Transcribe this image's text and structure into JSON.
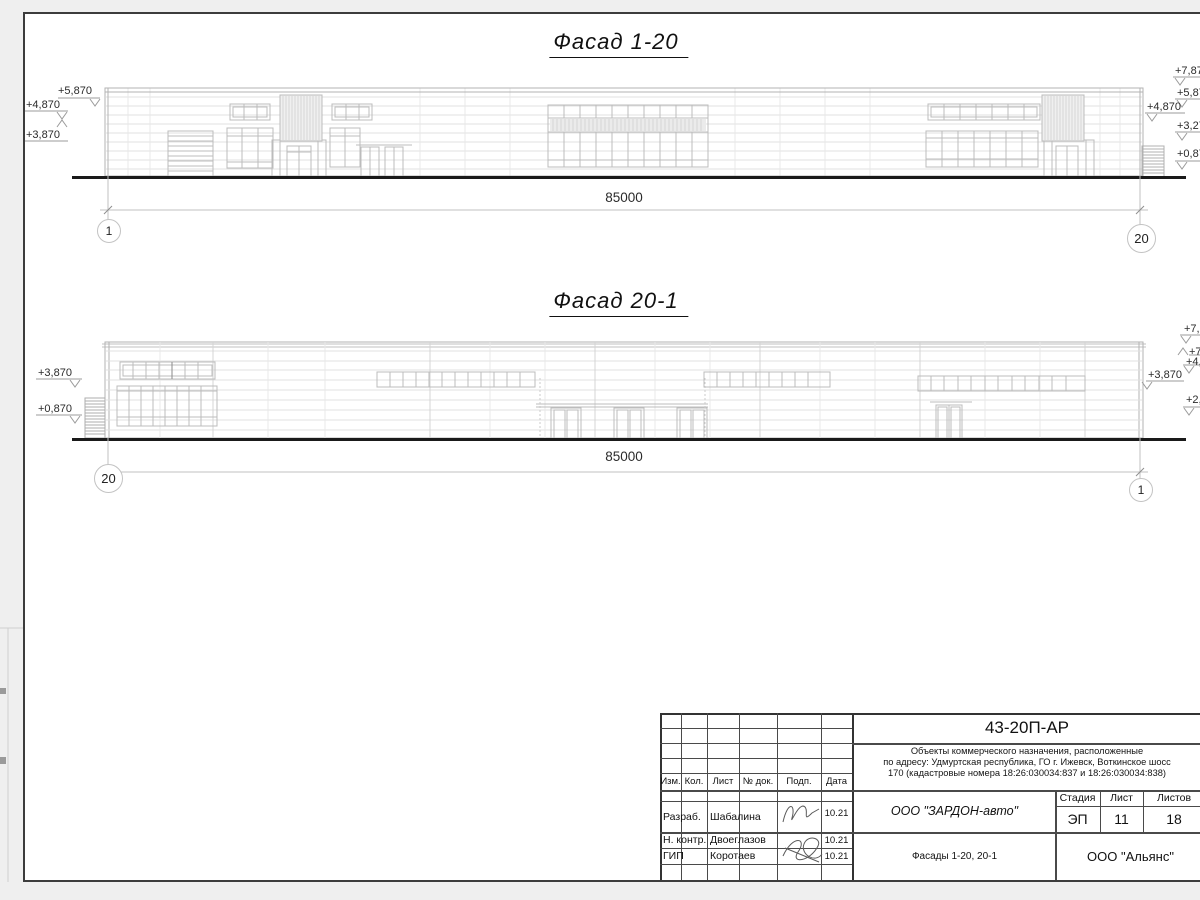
{
  "facade1": {
    "title": "Фасад 1-20",
    "dimension": "85000",
    "axis_left": "1",
    "axis_right": "20",
    "marks_left": [
      "+5,870",
      "+4,870",
      "+3,870"
    ],
    "marks_right": [
      "+7,87",
      "+5,87",
      "+4,870",
      "+3,27",
      "+0,87"
    ]
  },
  "facade2": {
    "title": "Фасад 20-1",
    "dimension": "85000",
    "axis_left": "20",
    "axis_right": "1",
    "marks_left": [
      "+3,870",
      "+0,870"
    ],
    "marks_right": [
      "+7,8",
      "+7,",
      "+4,8",
      "+3,870",
      "+2,1"
    ]
  },
  "titleblock": {
    "doc_number": "43-20П-АР",
    "desc1": "Объекты коммерческого назначения, расположенные",
    "desc2": "по адресу: Удмуртская республика, ГО г. Ижевск, Воткинское шосс",
    "desc3": "170 (кадастровые номера 18:26:030034:837 и 18:26:030034:838)",
    "header": {
      "izm": "Изм.",
      "kol": "Кол.",
      "list": "Лист",
      "doc": "№ док.",
      "podp": "Подп.",
      "data": "Дата"
    },
    "rows": [
      {
        "role": "Разраб.",
        "name": "Шабалина",
        "date": "10.21"
      },
      {
        "role": "Н. контр.",
        "name": "Двоеглазов",
        "date": "10.21"
      },
      {
        "role": "ГИП",
        "name": "Коротаев",
        "date": "10.21"
      }
    ],
    "company": "ООО \"ЗАРДОН-авто\"",
    "stage_label": "Стадия",
    "sheet_label": "Лист",
    "sheets_label": "Листов",
    "stage": "ЭП",
    "sheet_no": "11",
    "sheets_total": "18",
    "sheet_title": "Фасады 1-20, 20-1",
    "contractor": "ООО \"Альянс\""
  }
}
